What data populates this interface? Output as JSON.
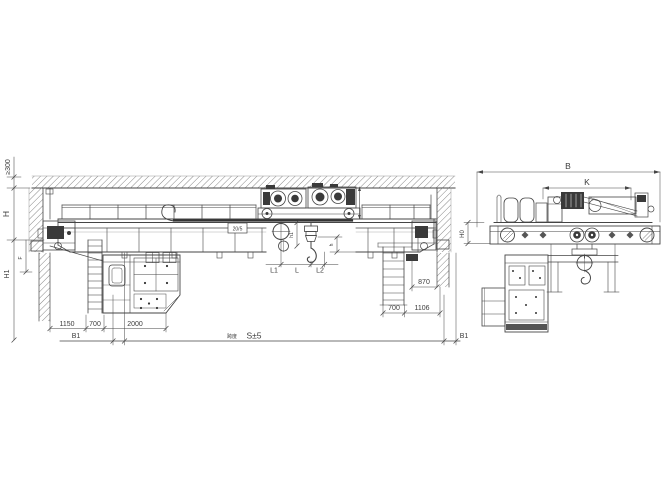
{
  "labels": {
    "clearance": "≥300",
    "H": "H",
    "F": "F",
    "H1": "H1",
    "B1_left": "B1",
    "B1_right": "B1",
    "dim_1150": "1150",
    "dim_700_cab": "700",
    "dim_2000": "2000",
    "span_word": "跨度",
    "span_value": "S±5",
    "dim_870": "870",
    "dim_700_ladder": "700",
    "dim_1106": "1106",
    "h1": "h1",
    "h": "h",
    "L1": "L1",
    "L": "L",
    "L2": "L2",
    "capacity": "20/5",
    "B": "B",
    "K": "K",
    "H0": "H0"
  },
  "colors": {
    "line": "#454545",
    "dark_fill": "#3a3a3a",
    "hatch": "#7a7a7a",
    "background": "#ffffff"
  }
}
